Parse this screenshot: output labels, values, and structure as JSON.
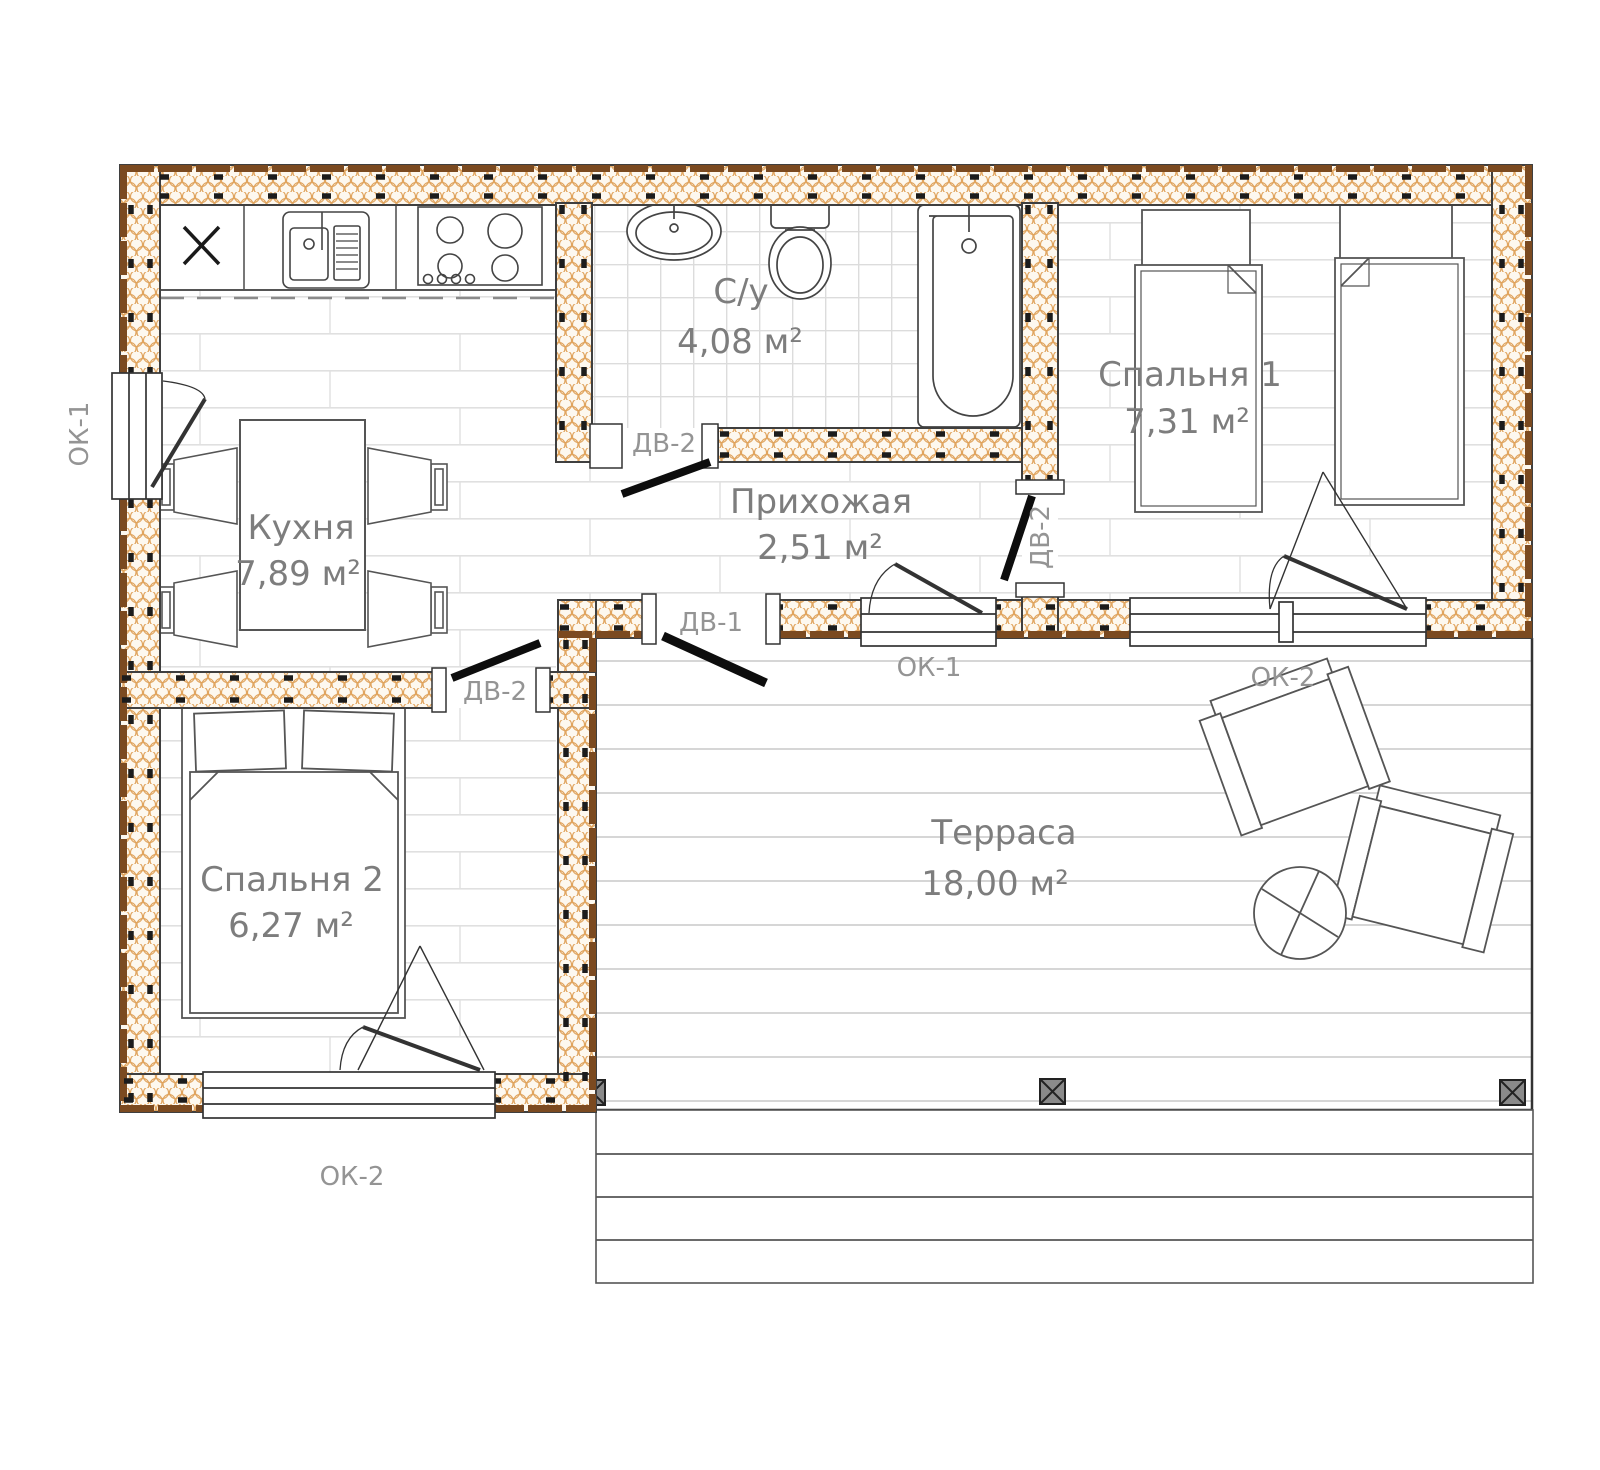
{
  "plan": {
    "rooms": {
      "kitchen": {
        "name": "Кухня",
        "area": "7,89 м²"
      },
      "bathroom": {
        "name": "С/у",
        "area": "4,08 м²"
      },
      "hallway": {
        "name": "Прихожая",
        "area": "2,51 м²"
      },
      "bedroom1": {
        "name": "Спальня 1",
        "area": "7,31 м²"
      },
      "bedroom2": {
        "name": "Спальня 2",
        "area": "6,27 м²"
      },
      "terrace": {
        "name": "Терраса",
        "area": "18,00 м²"
      }
    },
    "labels": {
      "west_window": "ОК-1",
      "hall_window": "ОК-1",
      "bedroom1_window": "ОК-2",
      "bedroom2_window": "ОК-2",
      "entry_door": "ДВ-1",
      "bath_door": "ДВ-2",
      "bedroom1_door": "ДВ-2",
      "bedroom2_door": "ДВ-2"
    },
    "colors": {
      "insulation": "#e0a45e",
      "wood_siding": "#7b4a20",
      "wall_line": "#3f3f3f",
      "floor_line": "#e0e0e0",
      "label_gray": "#7d7d7d",
      "door_black": "#0d0d0d"
    }
  }
}
